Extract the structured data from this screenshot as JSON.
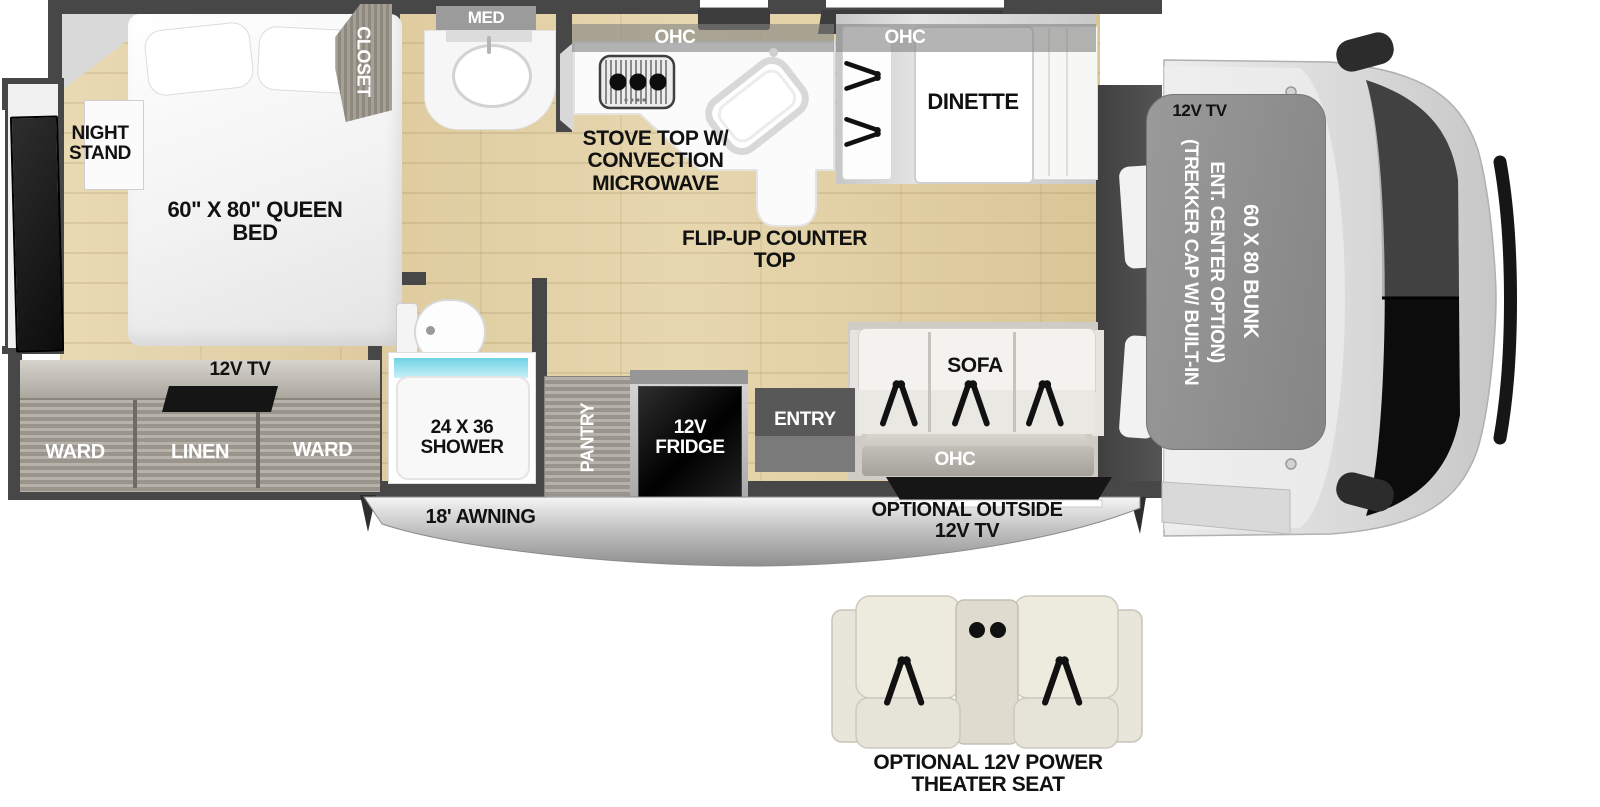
{
  "colors": {
    "wall": "#474747",
    "floor_wood": "#e3d3ab",
    "shower_water": "#6ed3e6",
    "cabinet_wood": "#b7b3ab",
    "appliance_black": "#111111",
    "cab_body": "#dcdcdc",
    "bunk_overlay": "#8e8e8e"
  },
  "bedroom": {
    "night_stand": "NIGHT STAND",
    "queen_bed": "60\" X 80\" QUEEN BED",
    "closet": "CLOSET",
    "tv": "12V TV",
    "ward_left": "WARD",
    "linen": "LINEN",
    "ward_right": "WARD"
  },
  "bathroom": {
    "med": "MED",
    "shower": "24 X 36 SHOWER"
  },
  "kitchen": {
    "ohc": "OHC",
    "stove": "STOVE TOP W/ CONVECTION MICROWAVE",
    "flip_up": "FLIP-UP COUNTER TOP",
    "pantry": "PANTRY",
    "fridge": "12V FRIDGE"
  },
  "dinette": {
    "ohc": "OHC",
    "label": "DINETTE"
  },
  "living": {
    "sofa": "SOFA",
    "ohc": "OHC",
    "entry": "ENTRY"
  },
  "cab": {
    "tv": "12V TV",
    "cap_note_line1": "(TREKKER CAP W/ BUILT-IN",
    "cap_note_line2": "ENT. CENTER OPTION)",
    "bunk": "60 X 80 BUNK"
  },
  "exterior": {
    "awning": "18' AWNING",
    "outside_tv": "OPTIONAL OUTSIDE 12V TV"
  },
  "options": {
    "theater_seat": "OPTIONAL 12V POWER THEATER SEAT"
  }
}
